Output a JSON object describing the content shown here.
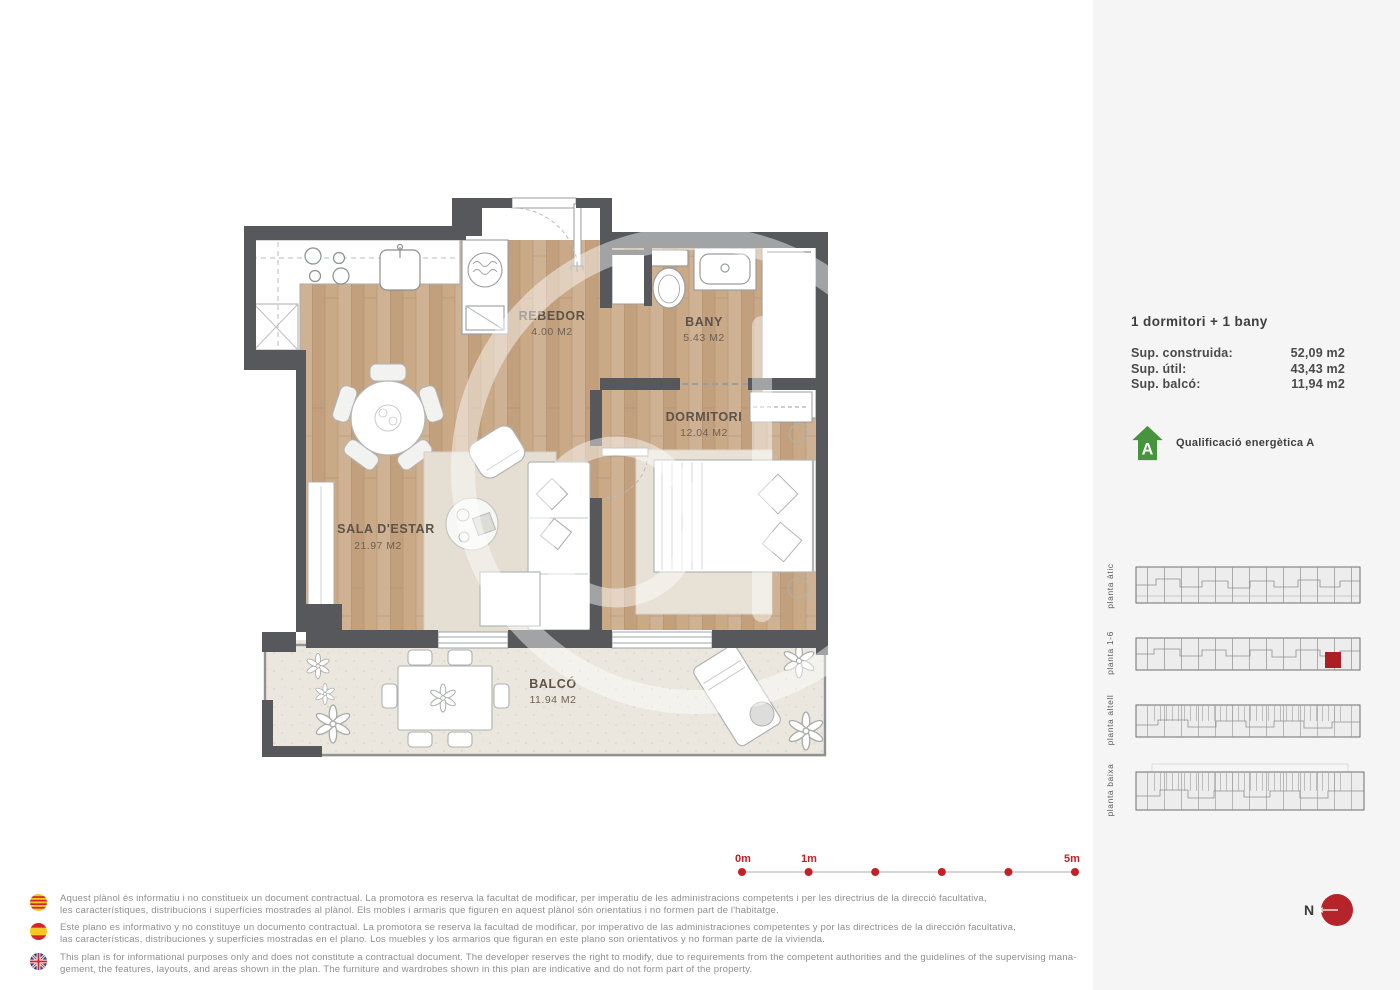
{
  "colors": {
    "wall": "#56585c",
    "wood_floor": "#c8a885",
    "balcony_floor": "#ebe7de",
    "accent_red": "#c42127",
    "energy_green": "#46953c",
    "panel_background": "#f5f5f5"
  },
  "plan": {
    "rooms": [
      {
        "name": "REBEDOR",
        "area": "4.00 M2"
      },
      {
        "name": "BANY",
        "area": "5.43 M2"
      },
      {
        "name": "DORMITORI",
        "area": "12.04 M2"
      },
      {
        "name": "SALA D'ESTAR",
        "area": "21.97 M2"
      },
      {
        "name": "BALCÓ",
        "area": "11.94 M2"
      }
    ]
  },
  "panel": {
    "title": "1 dormitori + 1 bany",
    "areas": [
      {
        "label": "Sup. construida:",
        "value": "52,09 m2"
      },
      {
        "label": "Sup. útil:",
        "value": "43,43 m2"
      },
      {
        "label": "Sup. balcó:",
        "value": "11,94 m2"
      }
    ],
    "energy": {
      "letter": "A",
      "label": "Qualificació energètica A"
    },
    "floors": [
      {
        "label": "planta àtic",
        "highlighted": false
      },
      {
        "label": "planta 1-6",
        "highlighted": true
      },
      {
        "label": "planta altell",
        "highlighted": false
      },
      {
        "label": "planta baixa",
        "highlighted": false
      }
    ]
  },
  "scalebar": {
    "labels": [
      "0m",
      "1m",
      "5m"
    ]
  },
  "compass": {
    "label": "N"
  },
  "disclaimers": [
    {
      "language": "català",
      "lines": [
        "Aquest plànol és informatiu i no constitueix un document contractual. La promotora es reserva la facultat de modificar, per imperatiu de les administracions competents i per les directrius de la direcció facultativa,",
        "les característiques, distribucions i superfícies mostrades al plànol. Els mobles i armaris que figuren en aquest plànol són orientatius i no formen part de l'habitatge."
      ]
    },
    {
      "language": "español",
      "lines": [
        "Este plano es informativo y no constituye un documento contractual. La promotora se reserva la facultad de modificar, por imperativo de las administraciones competentes y por las directrices de la dirección facultativa,",
        "las características, distribuciones y superficies mostradas en el plano. Los muebles y los armarios que figuran en este plano son orientativos y no forman parte de la vivienda."
      ]
    },
    {
      "language": "english",
      "lines": [
        "This plan is for informational purposes only and does not constitute a contractual document. The developer reserves the right to modify, due to requirements from the competent authorities and the guidelines of the supervising mana-",
        "gement, the features, layouts, and areas shown in the plan. The furniture and wardrobes shown in this plan are indicative and do not form part of the property."
      ]
    }
  ]
}
